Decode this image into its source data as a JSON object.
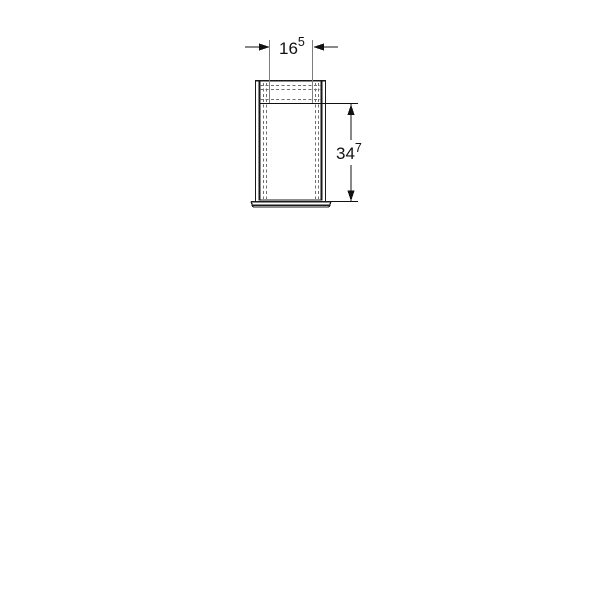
{
  "figure": {
    "kind": "technical-dimension-drawing",
    "view": "front elevation of a rectangular sleeve with base collar"
  },
  "dimensions": {
    "width": {
      "main": "16",
      "sup": "5"
    },
    "height": {
      "main": "34",
      "sup": "7"
    }
  },
  "colors": {
    "background": "#ffffff",
    "outline": "#1a1a1a",
    "hidden_line": "#6e6e6e",
    "extension_line": "#7d7d7d",
    "dimension": "#111111",
    "text": "#111111"
  }
}
